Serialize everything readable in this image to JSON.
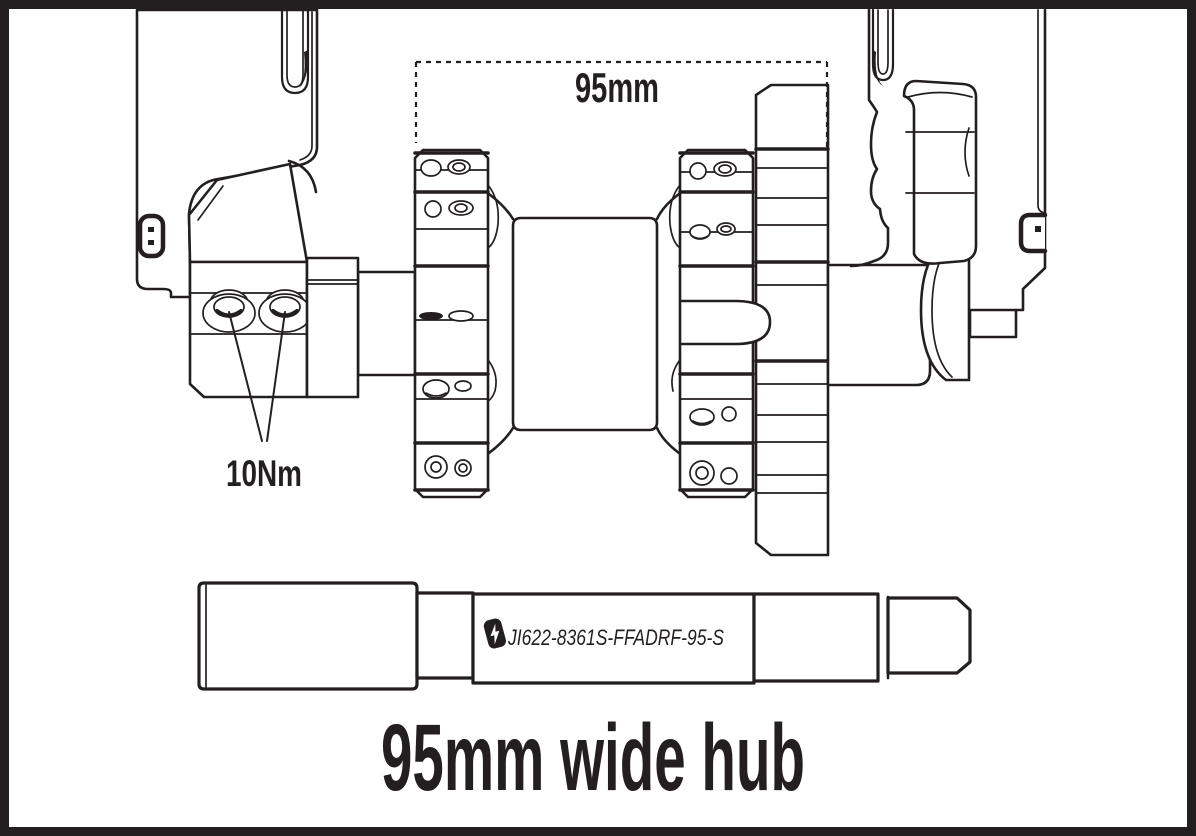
{
  "page": {
    "background": "#ffffff",
    "ink_color": "#231f20",
    "border_color": "#231f20"
  },
  "diagram": {
    "dimension_label": "95mm",
    "torque_label": "10Nm"
  },
  "axle": {
    "part_number": "JI622-8361S-FFADRF-95-S",
    "logo": "lightning-bolt"
  },
  "title": "95mm wide hub"
}
